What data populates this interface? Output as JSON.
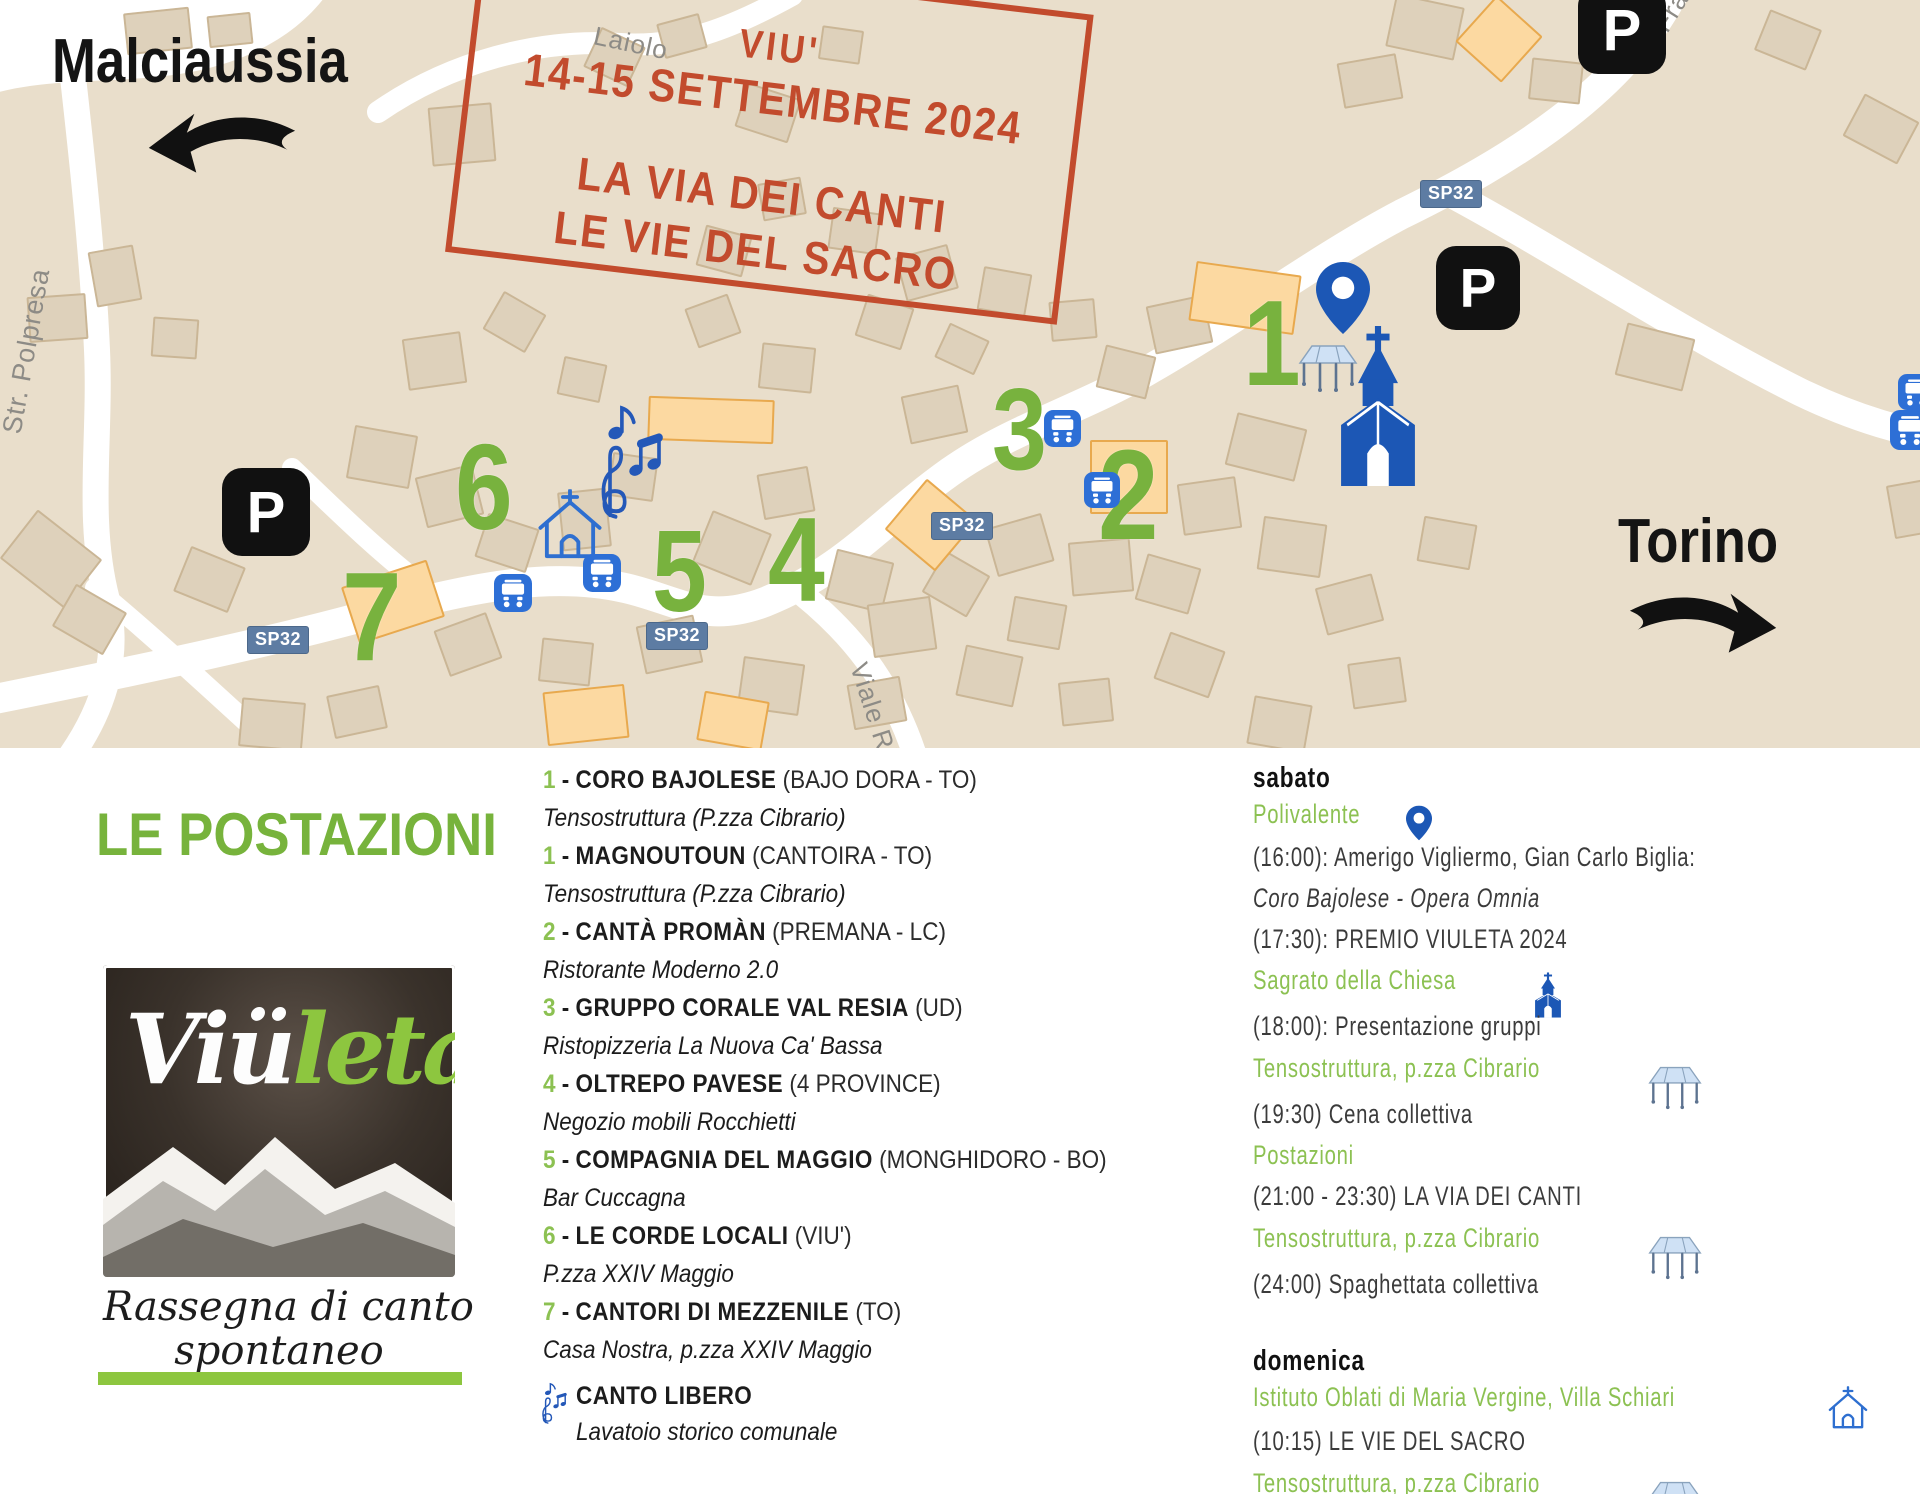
{
  "stamp": {
    "line1": "VIU'",
    "line2": "14-15 SETTEMBRE 2024",
    "line3": "LA VIA DEI CANTI",
    "line4": "LE VIE DEL SACRO"
  },
  "map": {
    "dest_left": "Malciaussia",
    "dest_right": "Torino",
    "parking_label": "P",
    "street_labels": [
      {
        "text": "Laiolo",
        "x": 594,
        "y": 20,
        "rot": 12,
        "size": 26
      },
      {
        "text": "Str. Polpresa",
        "x": 12,
        "y": 418,
        "rot": -80,
        "size": 27
      },
      {
        "text": "Frazione",
        "x": 1660,
        "y": 14,
        "rot": -58,
        "size": 26
      },
      {
        "text": "Viale Rimembranza",
        "x": 858,
        "y": 648,
        "rot": 72,
        "size": 26
      }
    ],
    "road_badges": [
      {
        "text": "SP32",
        "x": 1420,
        "y": 180
      },
      {
        "text": "SP32",
        "x": 247,
        "y": 626
      },
      {
        "text": "SP32",
        "x": 646,
        "y": 622
      },
      {
        "text": "SP32",
        "x": 931,
        "y": 512
      }
    ],
    "markers": [
      {
        "n": "1",
        "x": 1243,
        "y": 290,
        "size": 122
      },
      {
        "n": "2",
        "x": 1098,
        "y": 440,
        "size": 128
      },
      {
        "n": "3",
        "x": 992,
        "y": 378,
        "size": 116
      },
      {
        "n": "4",
        "x": 768,
        "y": 508,
        "size": 120
      },
      {
        "n": "5",
        "x": 652,
        "y": 520,
        "size": 116
      },
      {
        "n": "6",
        "x": 455,
        "y": 434,
        "size": 122
      },
      {
        "n": "7",
        "x": 342,
        "y": 562,
        "size": 126
      }
    ],
    "parking": [
      {
        "x": 1578,
        "y": -14,
        "size": 88
      },
      {
        "x": 1436,
        "y": 246,
        "size": 84
      },
      {
        "x": 222,
        "y": 468,
        "size": 88
      }
    ],
    "bus_stops": [
      {
        "x": 494,
        "y": 574,
        "size": 38
      },
      {
        "x": 583,
        "y": 554,
        "size": 38
      },
      {
        "x": 1044,
        "y": 410,
        "size": 37
      },
      {
        "x": 1084,
        "y": 472,
        "size": 36
      },
      {
        "x": 1898,
        "y": 374,
        "size": 36
      },
      {
        "x": 1890,
        "y": 410,
        "size": 40
      }
    ],
    "buildings": [
      [
        125,
        10,
        62,
        38,
        -6,
        0
      ],
      [
        208,
        14,
        40,
        28,
        -6,
        0
      ],
      [
        28,
        295,
        55,
        42,
        -4,
        0
      ],
      [
        92,
        248,
        42,
        52,
        -10,
        0
      ],
      [
        152,
        318,
        42,
        36,
        4,
        0
      ],
      [
        10,
        528,
        78,
        58,
        38,
        0
      ],
      [
        60,
        595,
        55,
        45,
        30,
        0
      ],
      [
        180,
        555,
        55,
        45,
        22,
        0
      ],
      [
        590,
        35,
        45,
        40,
        25,
        0
      ],
      [
        660,
        18,
        40,
        32,
        -15,
        0
      ],
      [
        430,
        105,
        60,
        55,
        -5,
        0
      ],
      [
        740,
        90,
        52,
        42,
        18,
        0
      ],
      [
        820,
        28,
        38,
        30,
        8,
        0
      ],
      [
        405,
        335,
        55,
        48,
        -8,
        0
      ],
      [
        490,
        300,
        45,
        40,
        30,
        0
      ],
      [
        560,
        360,
        40,
        35,
        12,
        0
      ],
      [
        690,
        300,
        42,
        38,
        -20,
        0
      ],
      [
        760,
        345,
        50,
        42,
        6,
        0
      ],
      [
        860,
        300,
        45,
        40,
        18,
        0
      ],
      [
        905,
        390,
        55,
        45,
        -12,
        0
      ],
      [
        940,
        330,
        40,
        34,
        25,
        0
      ],
      [
        350,
        430,
        60,
        50,
        10,
        0
      ],
      [
        420,
        470,
        55,
        48,
        -14,
        0
      ],
      [
        480,
        520,
        50,
        42,
        18,
        0
      ],
      [
        560,
        490,
        45,
        55,
        -6,
        0
      ],
      [
        610,
        455,
        42,
        40,
        8,
        0
      ],
      [
        700,
        520,
        60,
        52,
        22,
        0
      ],
      [
        760,
        470,
        48,
        42,
        -10,
        0
      ],
      [
        830,
        555,
        55,
        48,
        14,
        0
      ],
      [
        870,
        600,
        60,
        50,
        -8,
        0
      ],
      [
        930,
        560,
        48,
        44,
        30,
        0
      ],
      [
        990,
        520,
        55,
        46,
        -16,
        0
      ],
      [
        1010,
        600,
        50,
        42,
        10,
        0
      ],
      [
        1070,
        540,
        58,
        50,
        -5,
        0
      ],
      [
        1140,
        560,
        52,
        44,
        16,
        0
      ],
      [
        640,
        620,
        55,
        45,
        -12,
        0
      ],
      [
        540,
        640,
        48,
        40,
        6,
        0
      ],
      [
        440,
        620,
        52,
        45,
        -20,
        0
      ],
      [
        740,
        660,
        58,
        48,
        8,
        0
      ],
      [
        850,
        680,
        50,
        42,
        -10,
        0
      ],
      [
        960,
        650,
        55,
        48,
        12,
        0
      ],
      [
        1060,
        680,
        48,
        40,
        -6,
        0
      ],
      [
        1160,
        640,
        55,
        46,
        20,
        0
      ],
      [
        1230,
        420,
        68,
        50,
        14,
        0
      ],
      [
        1180,
        480,
        55,
        48,
        -8,
        0
      ],
      [
        1260,
        520,
        60,
        50,
        8,
        0
      ],
      [
        1320,
        580,
        55,
        45,
        -15,
        0
      ],
      [
        1420,
        520,
        50,
        42,
        10,
        0
      ],
      [
        1620,
        330,
        66,
        50,
        14,
        0
      ],
      [
        1760,
        18,
        52,
        40,
        22,
        0
      ],
      [
        1850,
        105,
        58,
        44,
        28,
        0
      ],
      [
        1890,
        480,
        60,
        50,
        -10,
        0
      ],
      [
        1390,
        0,
        66,
        50,
        12,
        0
      ],
      [
        1340,
        58,
        56,
        42,
        -10,
        0
      ],
      [
        1530,
        60,
        48,
        38,
        6,
        0
      ],
      [
        1150,
        300,
        55,
        45,
        -12,
        0
      ],
      [
        1100,
        350,
        48,
        40,
        14,
        0
      ],
      [
        1050,
        300,
        42,
        36,
        -5,
        0
      ],
      [
        980,
        270,
        45,
        40,
        10,
        0
      ],
      [
        900,
        250,
        50,
        42,
        -15,
        0
      ],
      [
        830,
        210,
        45,
        38,
        8,
        0
      ],
      [
        760,
        180,
        40,
        34,
        -10,
        0
      ],
      [
        700,
        230,
        44,
        38,
        15,
        0
      ],
      [
        240,
        700,
        60,
        45,
        5,
        0
      ],
      [
        330,
        690,
        50,
        40,
        -12,
        0
      ],
      [
        1250,
        700,
        55,
        45,
        10,
        0
      ],
      [
        1350,
        660,
        50,
        42,
        -8,
        0
      ],
      [
        648,
        398,
        122,
        40,
        2,
        1
      ],
      [
        1192,
        268,
        102,
        56,
        8,
        1
      ],
      [
        1090,
        440,
        74,
        70,
        0,
        1
      ],
      [
        348,
        572,
        86,
        56,
        -18,
        1
      ],
      [
        545,
        688,
        78,
        50,
        -6,
        1
      ],
      [
        700,
        696,
        62,
        46,
        10,
        1
      ],
      [
        1468,
        8,
        58,
        58,
        42,
        1
      ],
      [
        898,
        492,
        62,
        62,
        40,
        1
      ]
    ]
  },
  "legend": {
    "title": "LE POSTAZIONI",
    "logo": {
      "brand_white": "Viü",
      "brand_green": "leta",
      "subtitle_line1": "Rassegna di canto",
      "subtitle_line2": "spontaneo"
    },
    "entries": [
      {
        "num": "1",
        "name": "CORO BAJOLESE",
        "detail": "(BAJO DORA - TO)",
        "venue": "Tensostruttura (P.zza Cibrario)"
      },
      {
        "num": "1",
        "name": "MAGNOUTOUN",
        "detail": "(CANTOIRA - TO)",
        "venue": "Tensostruttura (P.zza Cibrario)"
      },
      {
        "num": "2",
        "name": "CANTÀ PROMÀN",
        "detail": "(PREMANA - LC)",
        "venue": "Ristorante Moderno 2.0"
      },
      {
        "num": "3",
        "name": "GRUPPO CORALE VAL RESIA",
        "detail": "(UD)",
        "venue": "Ristopizzeria La Nuova Ca' Bassa"
      },
      {
        "num": "4",
        "name": "OLTREPO PAVESE",
        "detail": "(4 PROVINCE)",
        "venue": "Negozio mobili Rocchietti"
      },
      {
        "num": "5",
        "name": "COMPAGNIA DEL MAGGIO",
        "detail": "(MONGHIDORO - BO)",
        "venue": "Bar Cuccagna"
      },
      {
        "num": "6",
        "name": "LE CORDE LOCALI",
        "detail": "(VIU')",
        "venue": "P.zza XXIV Maggio"
      },
      {
        "num": "7",
        "name": "CANTORI DI MEZZENILE",
        "detail": "(TO)",
        "venue": "Casa Nostra, p.zza XXIV Maggio"
      }
    ],
    "free_song": {
      "name": "CANTO LIBERO",
      "venue": "Lavatoio storico comunale"
    }
  },
  "schedule": {
    "saturday": {
      "title": "sabato",
      "items": [
        {
          "type": "location",
          "text": "Polivalente",
          "icon": "pin"
        },
        {
          "type": "event",
          "text": "(16:00): Amerigo Vigliermo, Gian Carlo Biglia:"
        },
        {
          "type": "event-italic",
          "text": "Coro Bajolese - Opera Omnia"
        },
        {
          "type": "event",
          "text": "(17:30): PREMIO VIULETA 2024"
        },
        {
          "type": "location",
          "text": "Sagrato della Chiesa",
          "icon": "church"
        },
        {
          "type": "event",
          "text": "(18:00): Presentazione gruppi"
        },
        {
          "type": "location",
          "text": "Tensostruttura, p.zza Cibrario",
          "icon": "tent"
        },
        {
          "type": "event",
          "text": "(19:30) Cena collettiva"
        },
        {
          "type": "location",
          "text": "Postazioni"
        },
        {
          "type": "event",
          "text": "(21:00 - 23:30) LA VIA DEI CANTI"
        },
        {
          "type": "location",
          "text": "Tensostruttura, p.zza Cibrario",
          "icon": "tent"
        },
        {
          "type": "event",
          "text": "(24:00) Spaghettata collettiva"
        }
      ]
    },
    "sunday": {
      "title": "domenica",
      "items": [
        {
          "type": "location",
          "text": "Istituto Oblati di Maria Vergine, Villa Schiari",
          "icon": "chapel"
        },
        {
          "type": "event",
          "text": "(10:15) LE VIE DEL SACRO"
        },
        {
          "type": "location",
          "text": "Tensostruttura, p.zza Cibrario",
          "icon": "tent"
        },
        {
          "type": "event",
          "text": "(12:30) Pranzo collettivo"
        }
      ]
    }
  },
  "colors": {
    "map_bg": "#e9decb",
    "stamp_red": "#c24b2d",
    "green_strong": "#77b33c",
    "green_soft": "#8cc152",
    "blue_icon": "#1c57b5",
    "badge_blue": "#5d7ca3"
  }
}
